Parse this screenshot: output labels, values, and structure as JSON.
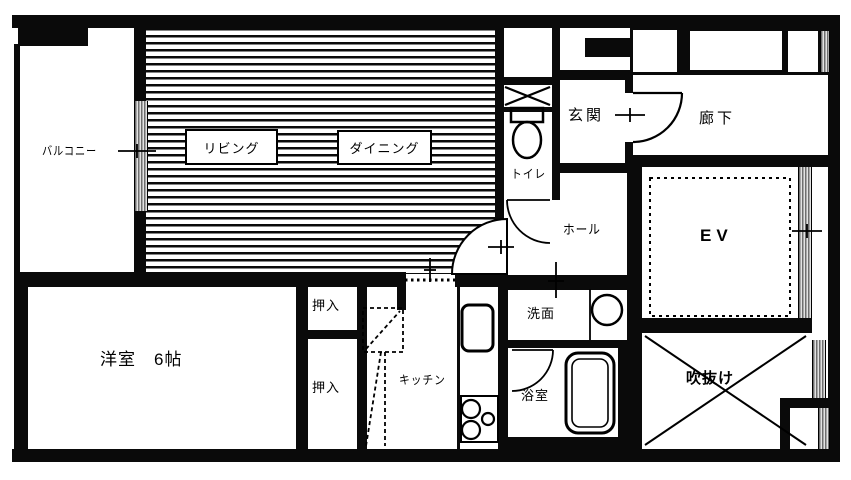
{
  "plan_title": "apartment floor plan",
  "colors": {
    "wall": "#0a0a0a",
    "paper": "#ffffff",
    "glass_hatch": "#6e6e6e"
  },
  "rooms": {
    "balcony": {
      "label": "バルコニー"
    },
    "living": {
      "label": "リビング"
    },
    "dining": {
      "label": "ダイニング"
    },
    "toilet": {
      "label": "トイレ"
    },
    "entrance": {
      "label": "玄関"
    },
    "corridor": {
      "label": "廊下"
    },
    "hall": {
      "label": "ホール"
    },
    "elevator": {
      "label": "EV"
    },
    "western_room": {
      "label": "洋室　6帖"
    },
    "closet_upper": {
      "label": "押入"
    },
    "closet_lower": {
      "label": "押入"
    },
    "kitchen": {
      "label": "キッチン"
    },
    "washroom": {
      "label": "洗面"
    },
    "bathroom": {
      "label": "浴室"
    },
    "atrium": {
      "label": "吹抜け"
    }
  }
}
